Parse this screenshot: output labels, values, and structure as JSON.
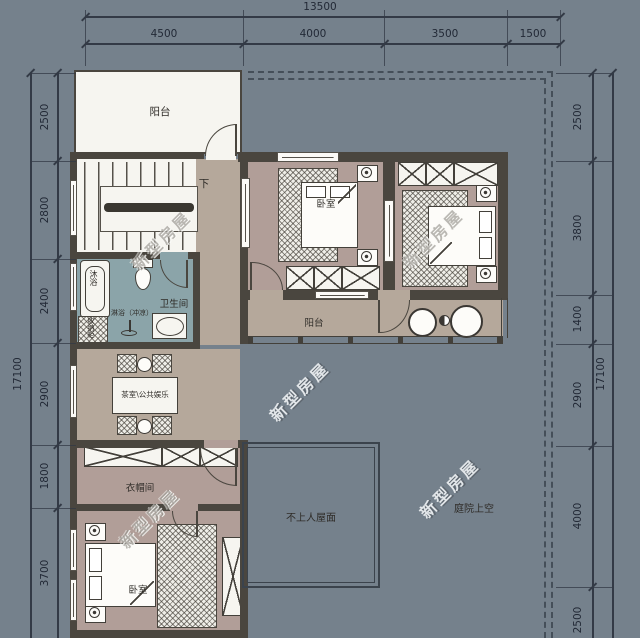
{
  "dimensions": {
    "top": {
      "total": "13500",
      "segments": [
        "4500",
        "4000",
        "3500",
        "1500"
      ]
    },
    "left": {
      "total": "17100",
      "segments": [
        "2500",
        "2800",
        "2400",
        "2900",
        "1800",
        "3700"
      ]
    },
    "right": {
      "total": "17100",
      "segments": [
        "2500",
        "3800",
        "1400",
        "2900",
        "4000",
        "2500"
      ]
    }
  },
  "rooms": {
    "balcony_top": {
      "label": "阳台"
    },
    "stairs": {
      "down_label": "下"
    },
    "bedroom_mid": {
      "label": "卧室"
    },
    "bathroom": {
      "label": "卫生间",
      "bath": "沐浴",
      "shower": "淋浴（冲凉）",
      "cabinet": "收纳柜"
    },
    "tea_room": {
      "label": "茶室\\公共娱乐"
    },
    "balcony_mid": {
      "label": "阳台"
    },
    "cloakroom": {
      "label": "衣帽间"
    },
    "bedroom_bottom": {
      "label": "卧室"
    },
    "roof": {
      "label": "不上人屋面"
    },
    "courtyard": {
      "label": "庭院上空"
    }
  },
  "watermark": {
    "text": "新型房屋"
  },
  "colors": {
    "background": "#75818c",
    "wall": "#4a463f",
    "floor_tan": "#b5a89b",
    "floor_mauve": "#b19e98",
    "floor_teal": "#8ba4a9",
    "floor_white": "#f6f5f0",
    "dim_text": "#222936"
  }
}
